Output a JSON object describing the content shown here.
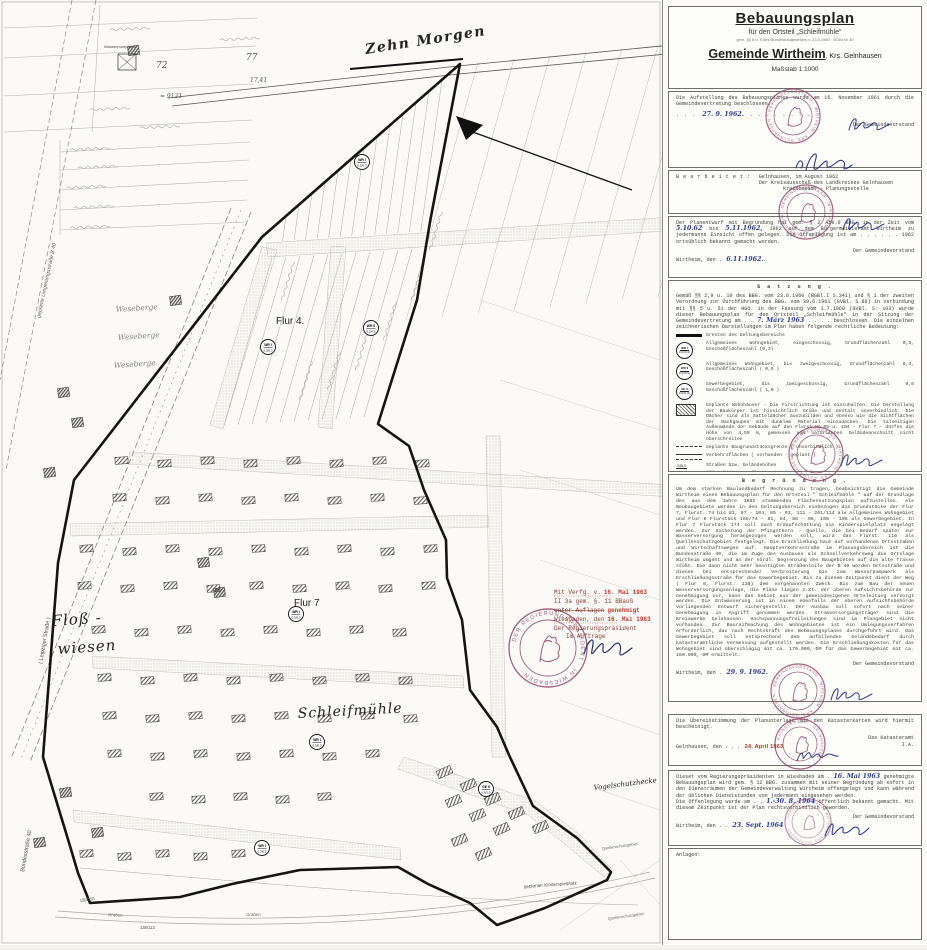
{
  "panel": {
    "title": {
      "line1": "Bebauungsplan",
      "line2": "für den Ortsteil „Schleifmühle“",
      "line3": "gem. §§ 8 u. 9 des Bundesbaugesetzes v. 23.6.1960 · BGBl Nr 30",
      "gemeinde": "Gemeinde Wirtheim",
      "krs": ", Krs. Gelnhausen",
      "massstab": "Maßstab 1:1000"
    },
    "aufstellung": {
      "text": "Die Aufstellung des Bebauungsplanes wurde am 16. November 1961 durch die Gemeindevertretung beschlossen.",
      "date_hand": "27. 9. 1962.",
      "right": "Der Gemeindevorstand"
    },
    "bearbeitet": {
      "label": "B e a r b e i t e t :",
      "line1": "Gelnhausen, im August 1962",
      "line2": "Der Kreisausschuß des Landkreises Gelnhausen",
      "line3": "Kreisbauamt - Planungsstelle"
    },
    "offenlegung62": {
      "t1": "Der Planentwurf mit Begründung hat gem. § 2 Abs.6 BBG. in der Zeit vom",
      "d1": "5.10.62",
      "t2": "bis",
      "d2": "5.11.1962,",
      "t3": "1962 auf dem Bürgermeisteramt Wirtheim zu jedermanns Einsicht offen gelegen. Die Offenlegung ist am . . . . . . 1962 ortsüblich bekannt gemacht worden.",
      "city": "Wirtheim, den .",
      "d3": "6.11.1962.",
      "right": "Der Gemeindevorstand"
    },
    "satzung": {
      "header": "S a t z u n g .",
      "intro_pre": "Gemäß §§ 2,9 u. 10 des BBG. vom 23.6.1960 (BGBl.I S.341) und § 1 der zweiten Verordnung zur Durchführung des BBG. vom 30.6.1961 (GVBl. S.86) in Verbindung mit §§ 5 u. 51 der HGO. in der Fassung vom 1.7.1960 (GVBl. S. 103) wurde dieser Bebauungsplan für den Ortsteil „Schleifmühle“ in der Sitzung der Gemeindevertretung am . .",
      "intro_date": "7. März 1963",
      "intro_post": ". . . . beschlossen. Die einzelnen zeichnerischen Darstellungen im Plan haben folgende rechtliche Bedeutung:",
      "legend": [
        {
          "text": "Grenzen des Geltungsbereichs"
        },
        {
          "sym1": "WR I",
          "sym2": "0,3/(0,3)",
          "text": "Allgemeines Wohngebiet, eingeschossig, Grundflächenzahl 0,3, Geschoßflächenzahl (0,3)"
        },
        {
          "sym1": "WR II",
          "sym2": "0,3/(0,5)",
          "text": "Allgemeines Wohngebiet, bis zweigeschossig, Grundflächenzahl 0,3, Geschoßflächenzahl ( 0,5 )"
        },
        {
          "sym1": "GE II",
          "sym2": "0,6/(1,0)",
          "text": "Gewerbegebiet, bis zweigeschossig, Grundflächenzahl 0,6 Geschoßflächenzahl ( 1,0 )"
        },
        {
          "text": "Geplante Wohnhäuser - Die Firstrichtung ist einzuhalten. Die Darstellung der Baukörper ist hinsichtlich Größe und Gestalt unverbindlich. Die Dächer sind als Satteldächer auszubilden und ebenso wie die Sichtflächen der Dachgaupen mit dunklem Material einzudecken. Die talseitigen Außenwände der Gebäude auf den Flurst.No.85 u. 104 - Flur 7 - dürfen die Höhe von 4,50 m, gemessen vom natürlichen Geländeanschnitt nicht überschreiten"
        },
        {
          "text": "Geplante Baugrundstücksgrenze  ( unverbindlich )"
        },
        {
          "text": "Verkehrsflächen   ( vorhanden - geplant )"
        },
        {
          "text": "Straßen bzw. Geländehöhen"
        },
        {
          "text": "Öffentliche Grünflächen  (Kinderspielplatz)"
        },
        {
          "text": "nicht überbaubare Grundstücksfläche"
        },
        {
          "text": "Baulinie"
        },
        {
          "text": "überbaubare Grundstücksfläche"
        }
      ],
      "city": "Wirtheim, den . .",
      "date_hand": "8. März",
      "year": ". . . . 1963",
      "right": "Der Gemeindevorstand"
    },
    "begruendung": {
      "header": "B e g r ü n d u n g .",
      "body": "Um dem starken Baulandbedarf Rechnung zu tragen, beabsichtigt die Gemeinde Wirtheim einen Bebauungsplan für den Ortsteil \" Schleifmühle \" auf der Grundlage des aus dem Jahre 1952 stammenden Flächennutzungsplan aufzustellen. Als Neubaugebiete werden in den Geltungsbereich einbezogen die Grundstücke der Flur 7, Flurst. 74 bis 81, 97 - 104, 85 - 93, 111 - 201/114 als Allgemeines Wohngebiet und Flur 8 Flurstück 168/74 - 81, 84, 88 - 96, 100 - 105 als Gewerbegebiet. In Flur 7 Flurstück 174 soll nach Erdaufschüttung ein Kinderspielplatz angelegt werden. Zur Sicherung der Pfingstborn - Quelle, die bei Bedarf später zur Wasserversorgung herangezogen werden soll, wird das Flurst. 110 als Quellenschutzgebiet festgelegt. Die Erschließung baut auf vorhandenen Ortsstraßen und Wirtschaftswegen auf. Hauptverkehrsstraße im Planungsbereich ist die Bundesstraße 40, die im Zuge des Ausbaues als Schnellverkehrsweg die Ortslage Wirtheim umgeht und an der nördl. Begrenzung des Baugebietes auf die alte Trasse stößt. Die dann nicht mehr benötigten Straßenteile der B 40 werden Ortsstraße und dienen bei entsprechender Verbreiterung bis zum Wasserpumpwerk als Erschließungsstraße für das Gewerbegebiet. Bis zu diesem Zeitpunkt dient der Weg ( Flur 8, Flurst. 138) dem vorgenannten Zweck. Bis zum Bau der neuen Wasserversorgungsanlage, die Pläne liegen z.Zt. der oberen Aufsichtsbehörde zur Genehmigung vor, kann das Gebiet aus der gemeindeeigenen Ortsleitung versorgt werden. Die Entwässerung ist in einem ebenfalls der oberen Aufsichtsbehörde vorliegenden Entwurf sichergestellt. Der Ausbau soll sofort nach seiner Genehmigung in Angriff genommen werden. Stromversorgungsträger sind die Kreiswerke Gelnhausen. Hochspannungsfreileitungen sind im Plangebiet nicht vorhanden. Zur Baureifmachung des Wohngebietes ist ein Umlegungsverfahren erforderlich, das nach Rechtskraft des Bebauungsplanes durchgeführt wird. Das Gewerbegebiet soll entsprechend dem anfallenden Geländebedarf durch katasteramtliche Vermessung aufgestellt werden. Die Erschließungskosten für das Wohngebiet sind überschlägig mit ca. 170.000,-DM für das Gewerbegebiet mit ca. 160.000,-DM ermittelt.",
      "city": "Wirtheim, den .",
      "date_hand": "29. 9. 1962.",
      "right": "Der Gemeindevorstand"
    },
    "kataster": {
      "text": "Die Übereinstimmung der Planunterlage mit den Katasterkarten wird hiermit bescheinigt.",
      "city": "Gelnhausen, den . . .",
      "date_stamp": "24. April 1963",
      "right1": "Das Katasteramt",
      "right2": "I.A."
    },
    "genehmigung": {
      "t1": "Dieser vom Regierungspräsidenten in Wiesbaden am .",
      "d1": "16. Mai 1963",
      "t2": "genehmigte Bebauungsplan wird gem. § 12 BBG. zusammen mit seiner Begründung ab sofort in den Diensträumen der Gemeindeverwaltung Wirtheim offengelegt und kann während der üblichen Dienststunden von jedermann eingesehen werden.",
      "t3": "Die Offenlegung wurde am . .",
      "d2": "1.-30. 8. 1964",
      "t4": "öffentlich bekannt gemacht. Mit diesem Zeitpunkt ist der Plan rechtsverbindlich geworden.",
      "city": "Wirtheim, den . .",
      "d3": "23. Sept. 1964",
      "right": "Der Gemeindevorstand"
    },
    "anlagen_label": "Anlagen:"
  },
  "map": {
    "labels": {
      "zehn_morgen": "Zehn Morgen",
      "flur4": "Flur 4.",
      "flur7": "Flur 7",
      "floss_a": "Floß -",
      "floss_b": "wiesen",
      "schleifmuehle": "Schleifmühle",
      "vogelschutzhecke": "Vogelschutzhecke",
      "kinderspielplatz": "geplanter Kinderspielplatz",
      "quellen1": "Quellenschutzgebiet",
      "quellen2": "Quellenschutzgebiet",
      "bundesstrasse": "Bundesstraße 40",
      "leipziger": "( Leipziger Straße )",
      "umgehung": "geplante Umgehungsstraße B 40",
      "wasserpumpwerk": "Wasserpumpwerk",
      "weseberge1": "Weseberge",
      "weseberge2": "Weseberge",
      "weseberge3": "Weseberge",
      "graben1": "Graben",
      "graben2": "Graben",
      "num72": "72",
      "num9121": "= 9121",
      "num77": "77",
      "num1741": "17,41",
      "frac1": "199/155",
      "frac2": "138/113"
    },
    "symbols": [
      {
        "t1": "WR I",
        "t2": "0,3/0,3"
      },
      {
        "t1": "WR I",
        "t2": "0,3/0,3"
      },
      {
        "t1": "WR II",
        "t2": "0,3/0,5"
      },
      {
        "t1": "WR I",
        "t2": "0,3/0,3"
      },
      {
        "t1": "WR I",
        "t2": "0,3/0,3"
      },
      {
        "t1": "GE II",
        "t2": "0,6/1,0"
      },
      {
        "t1": "WR I",
        "t2": "0,3/0,3"
      }
    ],
    "approval_block": {
      "l1a": "Mit Verfg. v.",
      "l1b": "16. Mai 1963",
      "l2": "II 3a gem. §. 11 BBauG",
      "l3a": "unter Auflagen",
      "l3b": "genehmigt",
      "l4a": "Wiesbaden, den",
      "l4b": "16. Mai 1963",
      "l5": "Der Regierungspräsident",
      "l6": "Im Auftrage"
    }
  },
  "stamps": {
    "regierung": "· DER REGIERUNGSPRÄSIDENT · IN WIESBADEN ·",
    "gemeinde": "· GEMEINDEVORSTAND · WIRTHEIM · KRS. GELNHAUSEN",
    "kataster": "· KATASTERAMT · GELNHAUSEN ·"
  },
  "colors": {
    "stamp_purple": "#8c3f63",
    "stamp_red": "#b2372d",
    "ink_blue": "#2e3d8c",
    "paper": "#fbfaf6"
  }
}
